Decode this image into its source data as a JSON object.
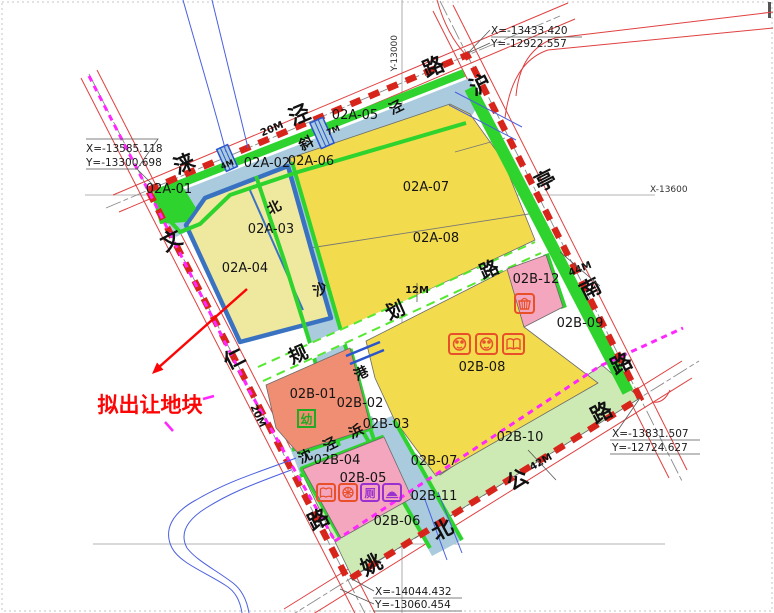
{
  "annotation": {
    "label": "拟出让地块"
  },
  "coords": {
    "top_left": {
      "x": "X=-13585.118",
      "y": "Y=-13300.698"
    },
    "top_right": {
      "x": "X=-13433.420",
      "y": "Y=-12922.557"
    },
    "right": {
      "x": "X=-13831.507",
      "y": "Y=-12724.627"
    },
    "bottom": {
      "x": "X=-14044.432",
      "y": "Y=-13060.454"
    },
    "grid_x": "X-13600",
    "grid_y": "Y-13000"
  },
  "roads": {
    "laijing": {
      "name": "涞泾路",
      "chars": [
        "涞",
        "泾",
        "路"
      ],
      "width": "20M"
    },
    "huting": {
      "name": "沪亭南路",
      "chars": [
        "沪",
        "亭",
        "南",
        "路"
      ],
      "width": "44M"
    },
    "wenren": {
      "name": "文仁路",
      "chars": [
        "文",
        "仁",
        "路"
      ],
      "width": "20M"
    },
    "yaobei": {
      "name": "姚北公路",
      "chars": [
        "姚",
        "北",
        "公",
        "路"
      ],
      "width": "42M"
    },
    "planned": {
      "name": "规划路",
      "chars": [
        "规",
        "划",
        "路"
      ],
      "width": "12M"
    }
  },
  "waters": {
    "xiejing": {
      "name": "斜泾",
      "chars": [
        "斜",
        "泾"
      ]
    },
    "beishagang": {
      "name": "北沙港",
      "chars": [
        "北",
        "沙",
        "港"
      ]
    },
    "shenjingbang": {
      "name": "沈泾浜",
      "chars": [
        "沈",
        "泾",
        "浜"
      ]
    }
  },
  "bridges": {
    "b1": "4M",
    "b2": "7M"
  },
  "parcels": [
    {
      "id": "02A-01"
    },
    {
      "id": "02A-02"
    },
    {
      "id": "02A-03"
    },
    {
      "id": "02A-04"
    },
    {
      "id": "02A-05"
    },
    {
      "id": "02A-06"
    },
    {
      "id": "02A-07"
    },
    {
      "id": "02A-08"
    },
    {
      "id": "02B-01"
    },
    {
      "id": "02B-02"
    },
    {
      "id": "02B-03"
    },
    {
      "id": "02B-04"
    },
    {
      "id": "02B-05"
    },
    {
      "id": "02B-06"
    },
    {
      "id": "02B-07"
    },
    {
      "id": "02B-08"
    },
    {
      "id": "02B-09"
    },
    {
      "id": "02B-10"
    },
    {
      "id": "02B-11"
    },
    {
      "id": "02B-12"
    }
  ],
  "icon_chars": {
    "kindergarten": "幼",
    "toilet": "厕"
  },
  "colors": {
    "boundary_red": "#d8251b",
    "magenta": "#ff26ff",
    "water_blue": "#a9cbdd",
    "parcel_yellow": "#f2db4d",
    "pale_yellow": "#efe9a0",
    "bright_green": "#2ed32e",
    "pale_green": "#cde9b4",
    "pink": "#f4a6be",
    "salmon": "#ef8e72",
    "blue_border": "#3a72c2",
    "lime_dash": "#55e830",
    "annotation_red": "#fd0505",
    "icon_orange": "#e8502a",
    "icon_purple": "#9b30d0"
  }
}
